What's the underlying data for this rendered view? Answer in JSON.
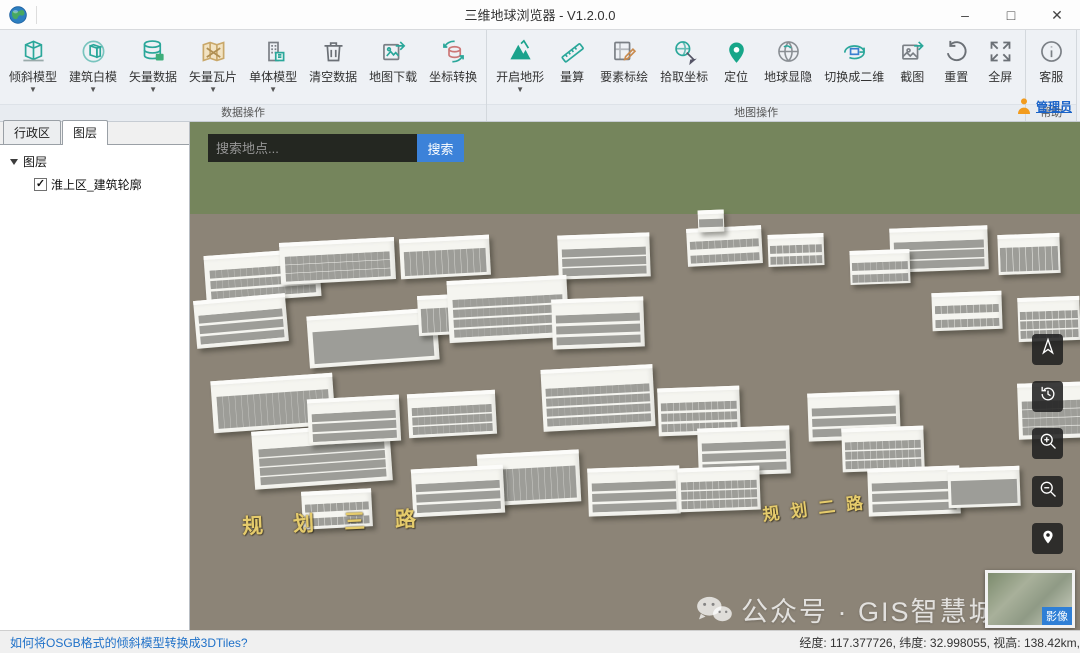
{
  "window": {
    "title": "三维地球浏览器 - V1.2.0.0",
    "minimize": "–",
    "maximize": "□",
    "close": "✕"
  },
  "toolbar": {
    "groups": [
      {
        "name": "数据操作",
        "buttons": [
          {
            "label": "倾斜模型",
            "icon": "tilt-model",
            "dropdown": true
          },
          {
            "label": "建筑白模",
            "icon": "white-model",
            "dropdown": true
          },
          {
            "label": "矢量数据",
            "icon": "vector-data",
            "dropdown": true
          },
          {
            "label": "矢量瓦片",
            "icon": "vector-tile",
            "dropdown": true
          },
          {
            "label": "单体模型",
            "icon": "single-model",
            "dropdown": true
          },
          {
            "label": "清空数据",
            "icon": "clear-data",
            "dropdown": false
          },
          {
            "label": "地图下载",
            "icon": "map-download",
            "dropdown": false
          },
          {
            "label": "坐标转换",
            "icon": "coord-transform",
            "dropdown": false
          }
        ]
      },
      {
        "name": "地图操作",
        "buttons": [
          {
            "label": "开启地形",
            "icon": "terrain",
            "dropdown": true
          },
          {
            "label": "量算",
            "icon": "measure",
            "dropdown": false
          },
          {
            "label": "要素标绘",
            "icon": "feature-plot",
            "dropdown": false
          },
          {
            "label": "拾取坐标",
            "icon": "pick-coord",
            "dropdown": false
          },
          {
            "label": "定位",
            "icon": "locate",
            "dropdown": false
          },
          {
            "label": "地球显隐",
            "icon": "globe-visibility",
            "dropdown": false
          },
          {
            "label": "切换成二维",
            "icon": "switch-2d",
            "dropdown": false
          },
          {
            "label": "截图",
            "icon": "screenshot",
            "dropdown": false
          },
          {
            "label": "重置",
            "icon": "reset",
            "dropdown": false
          },
          {
            "label": "全屏",
            "icon": "fullscreen",
            "dropdown": false
          }
        ]
      },
      {
        "name": "帮助",
        "buttons": [
          {
            "label": "客服",
            "icon": "customer-service",
            "dropdown": false
          }
        ]
      }
    ],
    "admin_label": "管理员"
  },
  "sidebar": {
    "tabs": [
      {
        "label": "行政区",
        "active": false
      },
      {
        "label": "图层",
        "active": true
      }
    ],
    "tree": {
      "root": "图层",
      "children": [
        {
          "label": "淮上区_建筑轮廓",
          "checked": true,
          "checkmark": "✓"
        }
      ]
    }
  },
  "map": {
    "search": {
      "placeholder": "搜索地点...",
      "button": "搜索"
    },
    "road_labels": [
      "规划三路",
      "规划二路"
    ],
    "watermark": "公众号 · GIS智慧城市",
    "basemap_badge": "影像",
    "controls": [
      {
        "name": "compass",
        "icon": "compass-icon"
      },
      {
        "name": "history",
        "icon": "history-icon"
      },
      {
        "name": "zoom-in",
        "icon": "zoom-in-icon"
      },
      {
        "name": "zoom-out",
        "icon": "zoom-out-icon"
      },
      {
        "name": "locate",
        "icon": "pin-icon"
      }
    ]
  },
  "statusbar": {
    "link": "如何将OSGB格式的倾斜模型转换成3DTiles?",
    "coordinates_text": "经度: 117.377726, 纬度: 32.998055, 视高: 138.42km,",
    "longitude": "117.377726",
    "latitude": "32.998055",
    "view_height": "138.42km"
  }
}
